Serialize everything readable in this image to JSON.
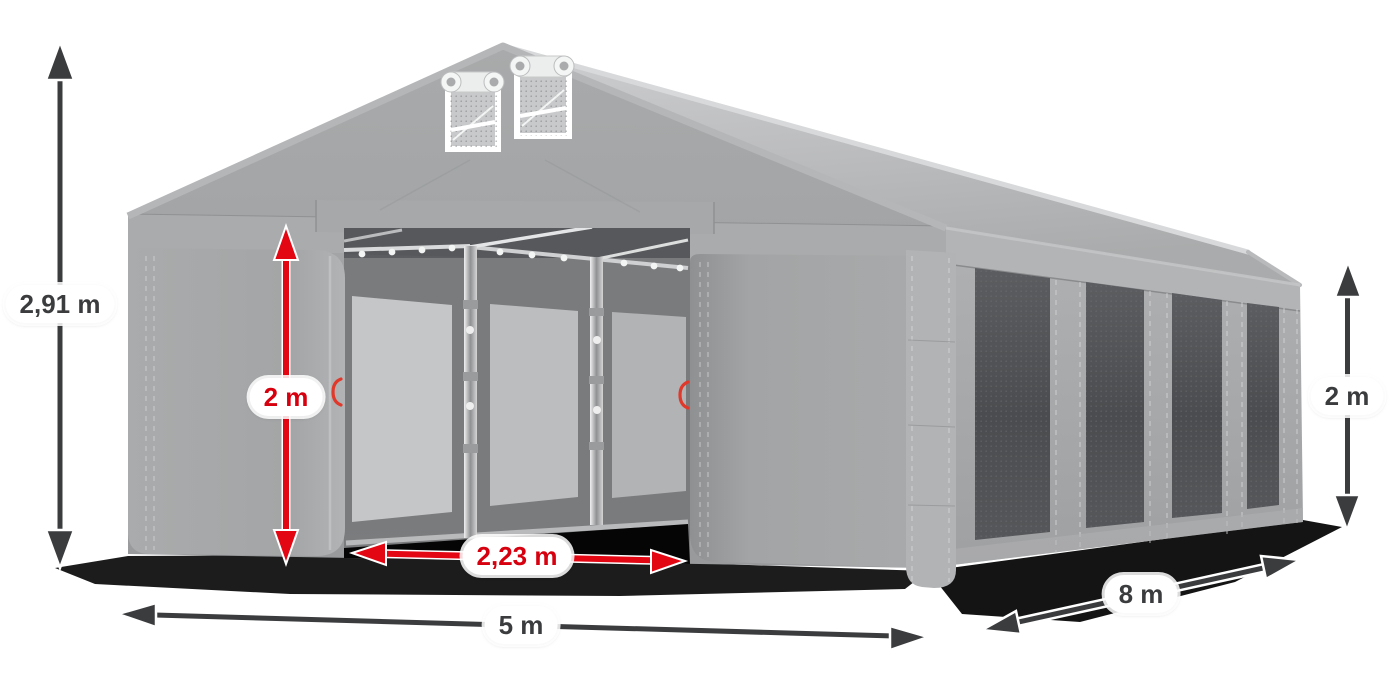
{
  "scene": {
    "description": "Grey party tent 5 x 8 m with open front entrance, two gable vents and four side mesh windows, annotated with dimensions",
    "background_color": "#ffffff",
    "tent": {
      "fabric_color": "#a6a8a9",
      "roof_color": "#c0c1c3",
      "mesh_window_color": "#4c4e51",
      "side_window_count": 4,
      "gable_vent_count": 2,
      "entrance_state": "open"
    }
  },
  "colors": {
    "dimension_arrow_dark": "#3b3c3e",
    "dimension_arrow_red": "#e30613",
    "label_background": "#ffffff",
    "label_text_dark": "#3b3c3e",
    "label_text_red": "#d6000f",
    "shadow": "#0a0a0a"
  },
  "annotations": {
    "total_height": {
      "text": "2,91 m",
      "style": "outer-dark"
    },
    "entrance_height": {
      "text": "2 m",
      "style": "inner-red"
    },
    "entrance_width": {
      "text": "2,23 m",
      "style": "inner-red"
    },
    "front_width": {
      "text": "5 m",
      "style": "outer-dark"
    },
    "side_length": {
      "text": "8 m",
      "style": "outer-dark"
    },
    "side_wall_height": {
      "text": "2 m",
      "style": "outer-dark"
    }
  }
}
